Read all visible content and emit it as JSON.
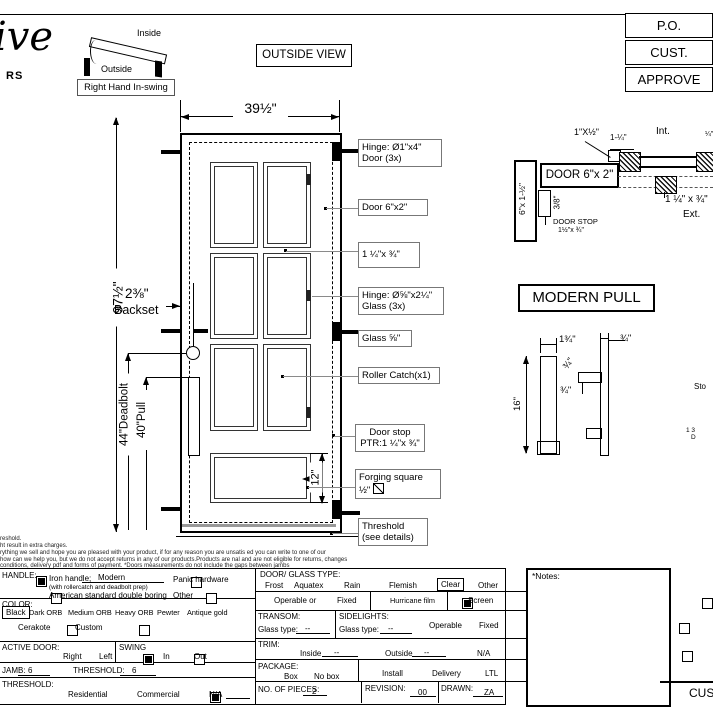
{
  "logo": {
    "script": "ive",
    "sub": "RS"
  },
  "swing_diagram": {
    "inside": "Inside",
    "outside": "Outside",
    "caption": "Right Hand In-swing"
  },
  "view_label": "OUTSIDE VIEW",
  "approval": {
    "rows": [
      "P.O.",
      "CUST.",
      "APPROVE"
    ]
  },
  "door": {
    "width_dim": "39½\"",
    "height_dim": "97½\"",
    "backset_dim": "2⅜\"",
    "backset_label": "Backset",
    "deadbolt_dim": "44\"Deadbolt",
    "pull_dim": "40\"Pull",
    "panel_dim": "12\""
  },
  "callouts": [
    {
      "l1": "Hinge: Ø1\"x4\"",
      "l2": "Door (3x)"
    },
    {
      "l1": "Door  6\"x2\""
    },
    {
      "l1": "1 ¼\"x ¾\""
    },
    {
      "l1": "Hinge: Ø⅝\"x2¼\"",
      "l2": "Glass (3x)"
    },
    {
      "l1": "Glass ⅝\""
    },
    {
      "l1": "Roller Catch(x1)"
    },
    {
      "l1": "Door stop",
      "l2": "PTR:1 ¼\"x ¾\""
    },
    {
      "l1": "Forging square",
      "l2": "½\""
    },
    {
      "l1": "Threshold",
      "l2": "(see details)"
    }
  ],
  "section": {
    "stop_strip": "1\"X½\"",
    "dim_1q": "1-¼\"",
    "int": "Int.",
    "door_box": "DOOR 6\"x 2\"",
    "jamb": "6\"x 1-½\"",
    "dim_38": "3/8\"",
    "door_stop": "DOOR STOP",
    "door_stop_dim": "1½\"x ¾\"",
    "block_dim": "1 ¼\" x ¾\"",
    "ext": "Ext.",
    "edge_frag": "¼\""
  },
  "pull": {
    "title": "MODERN PULL",
    "dim_134": "1¾\"",
    "dim_34a": "¾\"",
    "dim_34b": "¾\"",
    "dim_34c": "¾\"",
    "dim_16": "16\"",
    "frag1": "Sto",
    "frag2": "1 3",
    "frag3": "D"
  },
  "fine_print": {
    "l1": "reshold.",
    "l2": "ht result in extra charges.",
    "l3": "rything we sell and hope you are pleased with your product, if for any reason you are unsatis  ed you can write to one of our",
    "l4": "how can we help you, but we do not accept returns in any of our products.Products are    nal and are not eligible for returns, changes",
    "l5": "conditions, delivery pdf and forms of payment. *Doors measurements do not include the gaps between jambs"
  },
  "form": {
    "handle": {
      "label": "HANDLE:",
      "iron": {
        "checked": true,
        "label": "Iron handle;",
        "value": "Modern",
        "sub": "(with rollercatch and deadbolt prep)"
      },
      "american": {
        "checked": false,
        "label": "American standard double boring"
      },
      "panic": {
        "checked": false,
        "label": "Panic hardware"
      },
      "other": {
        "checked": false,
        "label": "Other"
      }
    },
    "color": {
      "label": "COLOR:",
      "options": [
        "Black",
        "Dark ORB",
        "Medium ORB",
        "Heavy ORB",
        "Pewter",
        "Antique gold"
      ],
      "selected": "Black",
      "cerakote": {
        "checked": false,
        "label": "Cerakote"
      },
      "custom": {
        "checked": false,
        "label": "Custom"
      }
    },
    "active_door": {
      "label": "ACTIVE DOOR:",
      "right": {
        "checked": true,
        "label": "Right"
      },
      "left": {
        "checked": false,
        "label": "Left"
      }
    },
    "swing": {
      "label": "SWING",
      "in": {
        "checked": true,
        "label": "In"
      },
      "out": {
        "checked": false,
        "label": "Out"
      }
    },
    "jamb": {
      "label": "JAMB:",
      "value": "6"
    },
    "threshold_size": {
      "label": "THRESHOLD:",
      "value": "6"
    },
    "threshold": {
      "label": "THRESHOLD:",
      "residential": {
        "checked": true,
        "label": "Residential"
      },
      "commercial": {
        "checked": false,
        "label": "Commercial"
      },
      "na": {
        "checked": false,
        "label": "N/A"
      }
    },
    "glass": {
      "label": "DOOR/ GLASS TYPE:",
      "options": [
        "Frost",
        "Aquatex",
        "Rain",
        "Flemish",
        "Clear",
        "Other"
      ],
      "selected": "Clear"
    },
    "operable_row": {
      "operable": {
        "checked": true,
        "label": "Operable  or"
      },
      "fixed": {
        "checked": false,
        "label": "Fixed"
      },
      "hurricane": {
        "checked": false,
        "label": "Hurricane film"
      },
      "screen": {
        "checked": false,
        "label": "Screen"
      }
    },
    "transom": {
      "label": "TRANSOM:",
      "glass_label": "Glass type:",
      "value": "--"
    },
    "sidelights": {
      "label": "SIDELIGHTS:",
      "glass_label": "Glass type:",
      "value": "--",
      "operable": {
        "checked": false,
        "label": "Operable"
      },
      "fixed": {
        "checked": false,
        "label": "Fixed"
      }
    },
    "trim": {
      "label": "TRIM:",
      "inside": {
        "checked": false,
        "label": "Inside",
        "value": "--"
      },
      "outside": {
        "checked": false,
        "label": "Outside",
        "value": "--"
      },
      "na": {
        "checked": false,
        "label": "N/A"
      }
    },
    "package": {
      "label": "PACKAGE:",
      "box": {
        "checked": false,
        "label": "Box"
      },
      "no_box": {
        "checked": true,
        "label": "No box"
      },
      "install": {
        "checked": false,
        "label": "Install"
      },
      "delivery": {
        "checked": false,
        "label": "Delivery"
      },
      "ltl": {
        "checked": false,
        "label": "LTL"
      }
    },
    "pieces": {
      "label": "NO. OF  PIECES:",
      "value": "2"
    },
    "revision": {
      "label": "REVISION:",
      "value": "00"
    },
    "drawn": {
      "label": "DRAWN:",
      "value": "ZA"
    },
    "notes_label": "*Notes:",
    "signature": "CUS"
  }
}
